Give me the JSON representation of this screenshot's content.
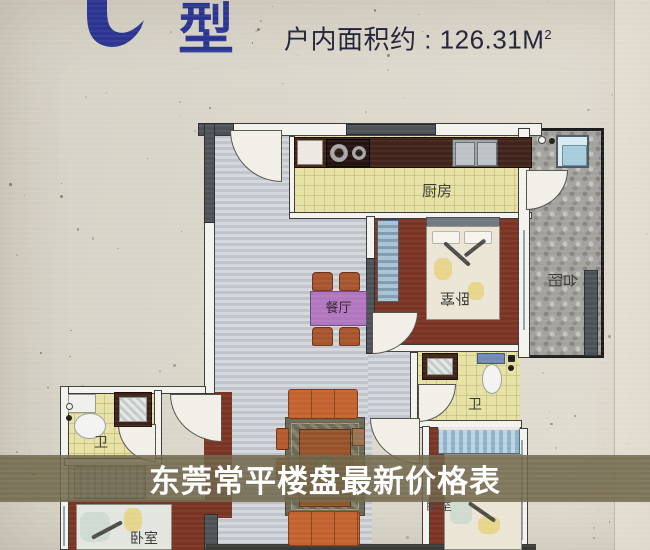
{
  "header": {
    "type_label": "型",
    "area_label": "户内面积约 : 126.31M",
    "area_exponent": "2"
  },
  "rooms": {
    "kitchen": "厨房",
    "dining": "餐厅",
    "master_bedroom": "卧室",
    "left_bedroom": "卧室",
    "right_bedroom": "卧室",
    "balcony": "阳台",
    "bath_center": "卫",
    "bath_left": "卫"
  },
  "caption": {
    "text": "东莞常平楼盘最新价格表"
  },
  "colors": {
    "brand_blue": "#2b3490",
    "caption_band": "rgba(110,101,73,0.87)",
    "bedroom_floor": "#7a3424",
    "tile_yellow": "#e6e2a4",
    "balcony_grey": "#a3a29e",
    "living_floor": "#c5cacf",
    "sofa_orange": "#c2622e",
    "dining_table_purple": "#b077be"
  }
}
